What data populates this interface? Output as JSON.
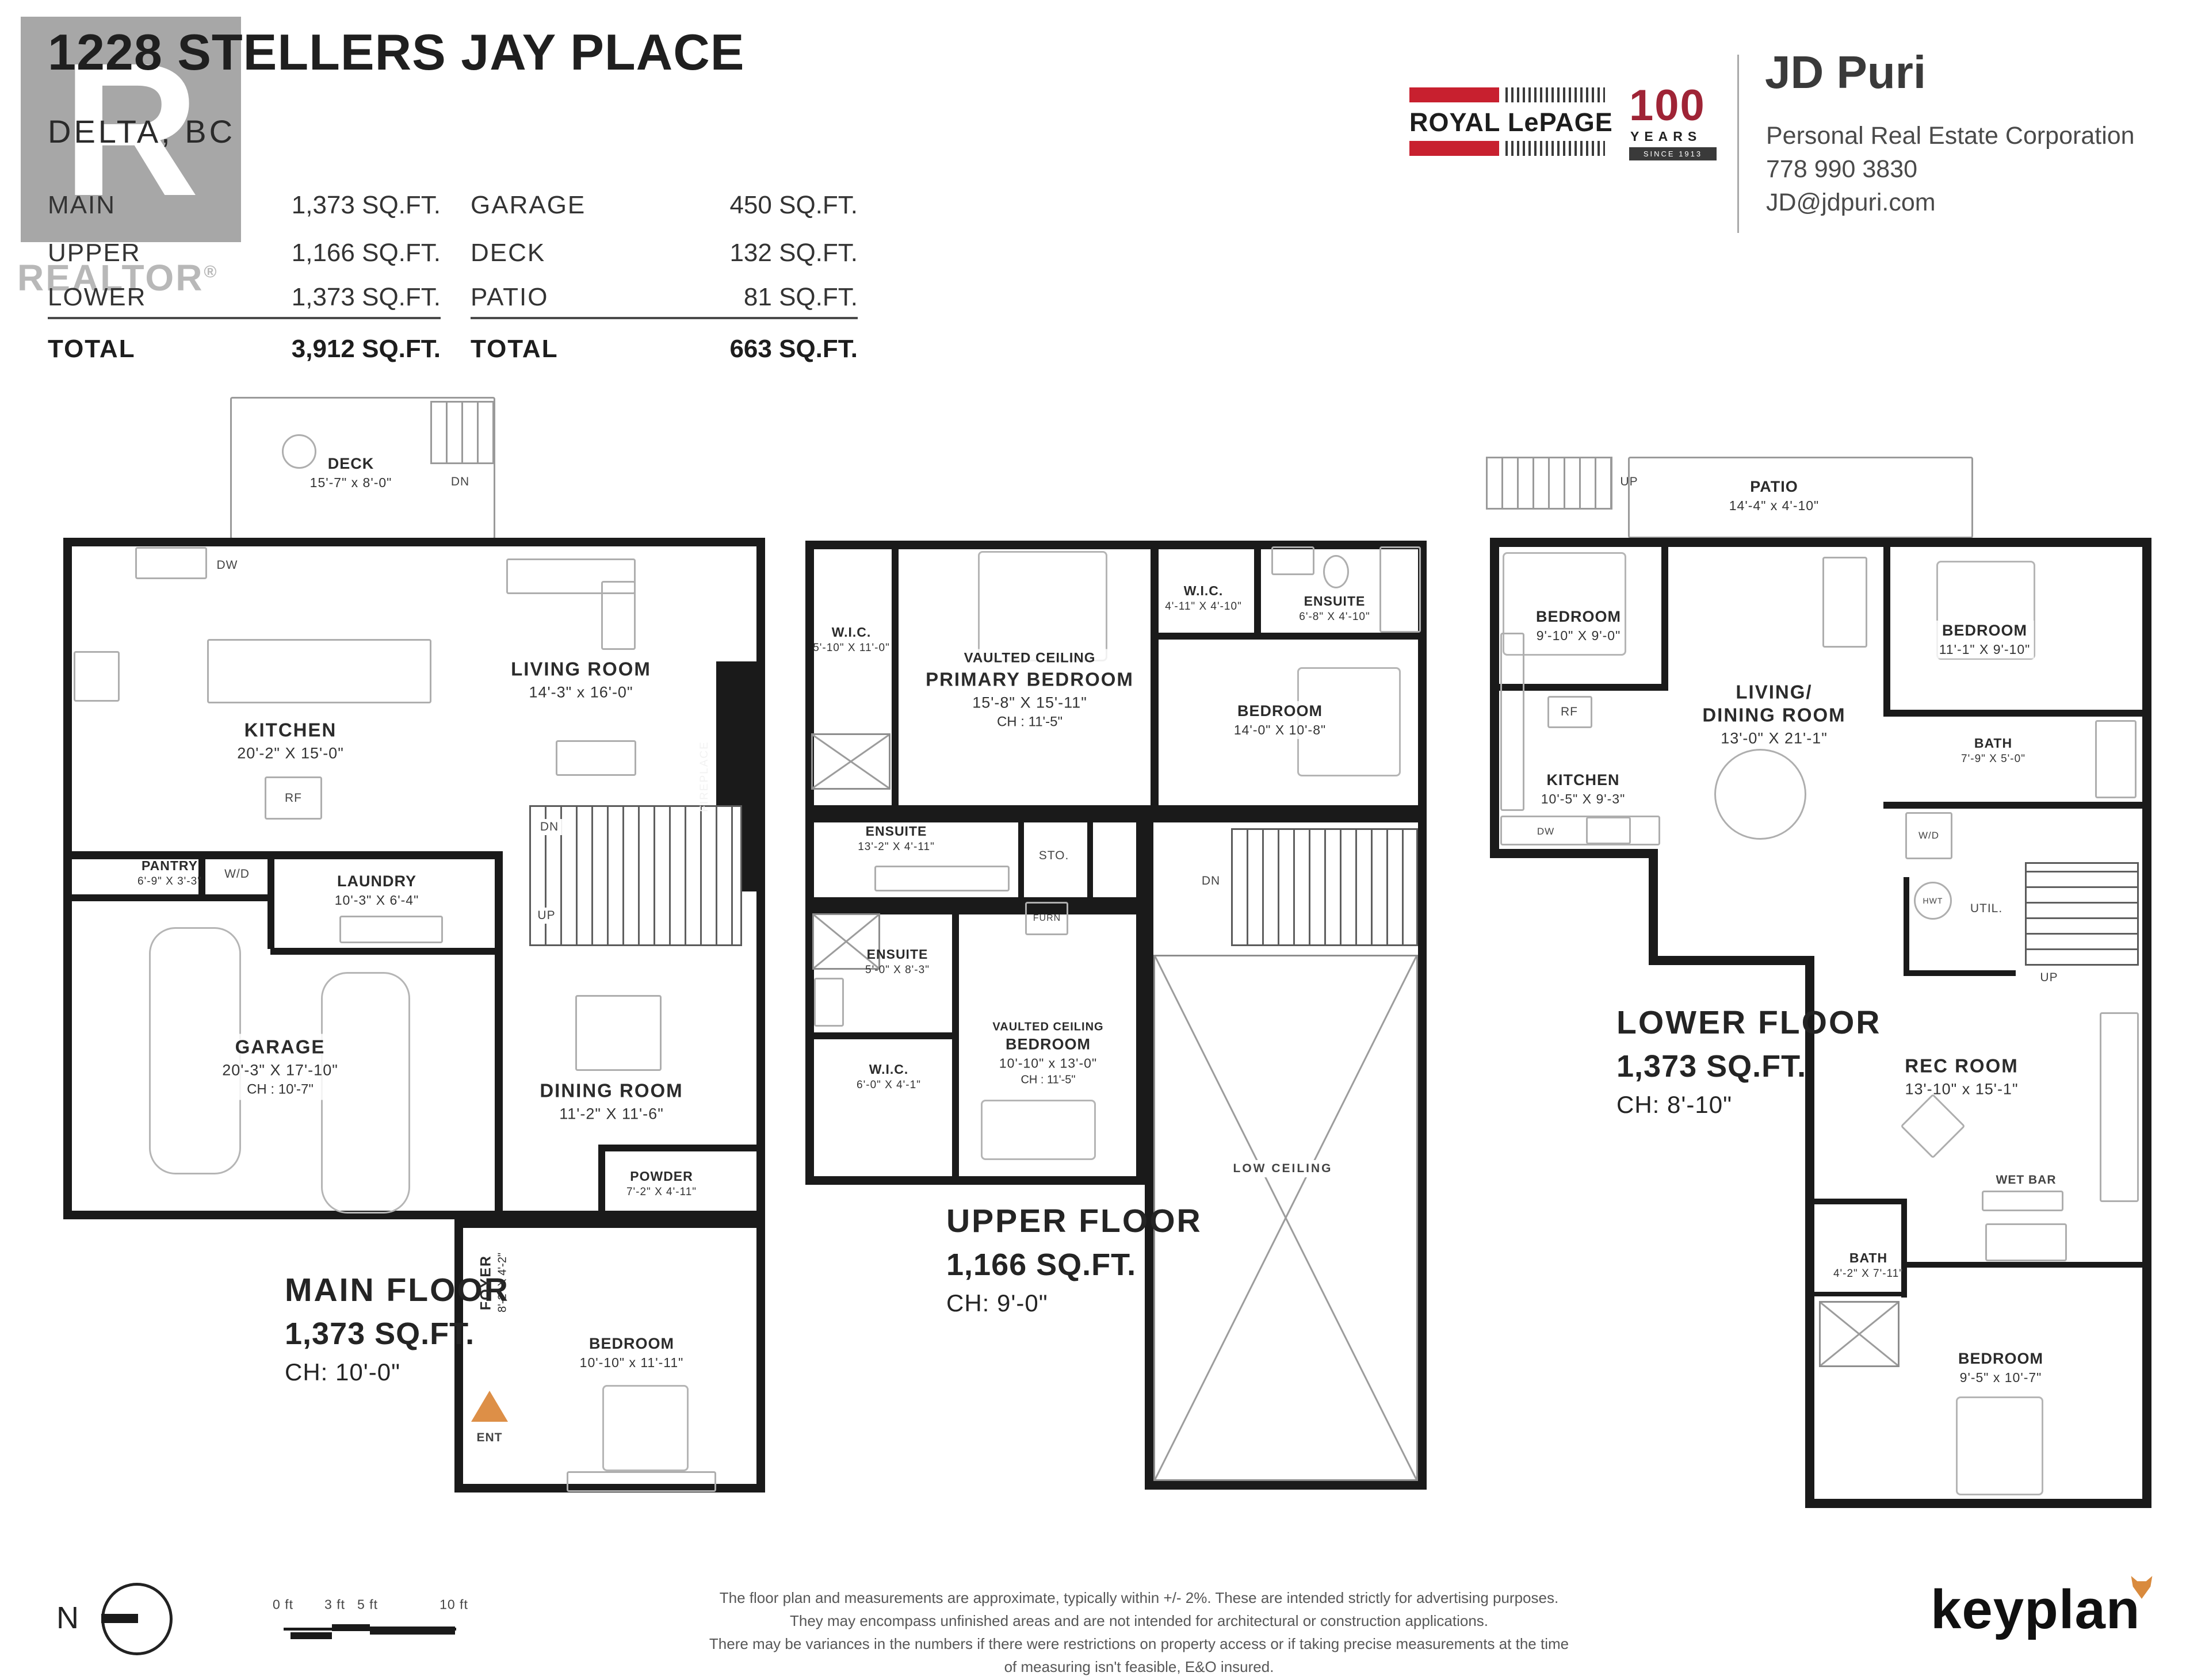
{
  "header": {
    "title": "1228 STELLERS JAY PLACE",
    "city": "DELTA, BC",
    "watermark": {
      "letter": "R",
      "label": "REALTOR",
      "reg": "®"
    },
    "table": {
      "col1": [
        {
          "label": "MAIN",
          "value": "1,373 SQ.FT."
        },
        {
          "label": "UPPER",
          "value": "1,166 SQ.FT."
        },
        {
          "label": "LOWER",
          "value": "1,373 SQ.FT."
        }
      ],
      "col2": [
        {
          "label": "GARAGE",
          "value": "450 SQ.FT."
        },
        {
          "label": "DECK",
          "value": "132 SQ.FT."
        },
        {
          "label": "PATIO",
          "value": "81 SQ.FT."
        }
      ],
      "total1": {
        "label": "TOTAL",
        "value": "3,912 SQ.FT."
      },
      "total2": {
        "label": "TOTAL",
        "value": "663 SQ.FT."
      }
    }
  },
  "agent": {
    "brand": "ROYAL LePAGE",
    "badge_num": "100",
    "badge_years": "YEARS",
    "badge_since": "SINCE 1913",
    "name": "JD Puri",
    "corp": "Personal Real Estate Corporation",
    "phone": "778 990 3830",
    "email": "JD@jdpuri.com"
  },
  "colors": {
    "accent_red": "#c8202f",
    "accent_orange": "#dd8f47",
    "wall": "#1a1a1a"
  },
  "floors": {
    "main": {
      "title": "MAIN FLOOR",
      "area": "1,373 SQ.FT.",
      "ch": "CH: 10'-0\"",
      "deck": {
        "name": "DECK",
        "dims": "15'-7\" x 8'-0\""
      },
      "deck_dn": "DN",
      "kitchen": {
        "name": "KITCHEN",
        "dims": "20'-2\" X 15'-0\""
      },
      "dw": "DW",
      "rf": "RF",
      "living": {
        "name": "LIVING ROOM",
        "dims": "14'-3\" x 16'-0\""
      },
      "fireplace": "FIREPLACE",
      "pantry": {
        "name": "PANTRY",
        "dims": "6'-9\" X 3'-3\""
      },
      "wd": "W/D",
      "laundry": {
        "name": "LAUNDRY",
        "dims": "10'-3\" X 6'-4\""
      },
      "stairs_dn": "DN",
      "stairs_up": "UP",
      "garage": {
        "name": "GARAGE",
        "dims": "20'-3\" X 17'-10\"",
        "ch": "CH : 10'-7\""
      },
      "dining": {
        "name": "DINING ROOM",
        "dims": "11'-2\" X 11'-6\""
      },
      "powder": {
        "name": "POWDER",
        "dims": "7'-2\" X 4'-11\""
      },
      "foyer": {
        "name": "FOYER",
        "dims": "8'-2\" X 4'-2\""
      },
      "ent": "ENT",
      "bedroom": {
        "name": "BEDROOM",
        "dims": "10'-10\" x 11'-11\""
      }
    },
    "upper": {
      "title": "UPPER FLOOR",
      "area": "1,166 SQ.FT.",
      "ch": "CH: 9'-0\"",
      "wic1": {
        "name": "W.I.C.",
        "dims": "5'-10\" X 11'-0\""
      },
      "primary": {
        "note": "VAULTED CEILING",
        "name": "PRIMARY BEDROOM",
        "dims": "15'-8\" X 15'-11\"",
        "ch": "CH : 11'-5\""
      },
      "wic2": {
        "name": "W.I.C.",
        "dims": "4'-11\" X 4'-10\""
      },
      "ensuite1": {
        "name": "ENSUITE",
        "dims": "6'-8\" X 4'-10\""
      },
      "bedroom1": {
        "name": "BEDROOM",
        "dims": "14'-0\" X 10'-8\""
      },
      "ensuite2": {
        "name": "ENSUITE",
        "dims": "13'-2\" X 4'-11\""
      },
      "sto": "STO.",
      "furn": "FURN",
      "dn": "DN",
      "ensuite3": {
        "name": "ENSUITE",
        "dims": "5'-0\" X 8'-3\""
      },
      "wic3": {
        "name": "W.I.C.",
        "dims": "6'-0\" X 4'-1\""
      },
      "bedroom2": {
        "note": "VAULTED CEILING",
        "name": "BEDROOM",
        "dims": "10'-10\" x 13'-0\"",
        "ch": "CH : 11'-5\""
      },
      "low_ceiling": "LOW CEILING"
    },
    "lower": {
      "title": "LOWER FLOOR",
      "area": "1,373 SQ.FT.",
      "ch": "CH: 8'-10\"",
      "up1": "UP",
      "patio": {
        "name": "PATIO",
        "dims": "14'-4\" x 4'-10\""
      },
      "bedroom1": {
        "name": "BEDROOM",
        "dims": "9'-10\" X 9'-0\""
      },
      "rf": "RF",
      "living": {
        "name1": "LIVING/",
        "name2": "DINING ROOM",
        "dims": "13'-0\" X 21'-1\""
      },
      "bedroom2": {
        "name": "BEDROOM",
        "dims": "11'-1\" X 9'-10\""
      },
      "bath1": {
        "name": "BATH",
        "dims": "7'-9\" X 5'-0\""
      },
      "wd": "W/D",
      "kitchen": {
        "name": "KITCHEN",
        "dims": "10'-5\" X 9'-3\""
      },
      "dw": "DW",
      "hwt": "HWT",
      "util": "UTIL.",
      "up2": "UP",
      "rec": {
        "name": "REC ROOM",
        "dims": "13'-10\" x 15'-1\""
      },
      "wetbar": "WET BAR",
      "bath2": {
        "name": "BATH",
        "dims": "4'-2\" X 7'-11\""
      },
      "bedroom3": {
        "name": "BEDROOM",
        "dims": "9'-5\" x 10'-7\""
      }
    }
  },
  "footer": {
    "north": "N",
    "scale": [
      "0 ft",
      "3 ft",
      "5 ft",
      "10 ft"
    ],
    "disclaimer": [
      "The floor plan and measurements are approximate, typically within +/- 2%. These are intended strictly for advertising purposes.",
      "They may encompass unfinished areas and are not intended for architectural or construction applications.",
      "There may be variances in the numbers if there were restrictions on property access or if taking precise measurements at the time of measuring isn't feasible, E&O insured."
    ],
    "logo": "keyplan"
  }
}
